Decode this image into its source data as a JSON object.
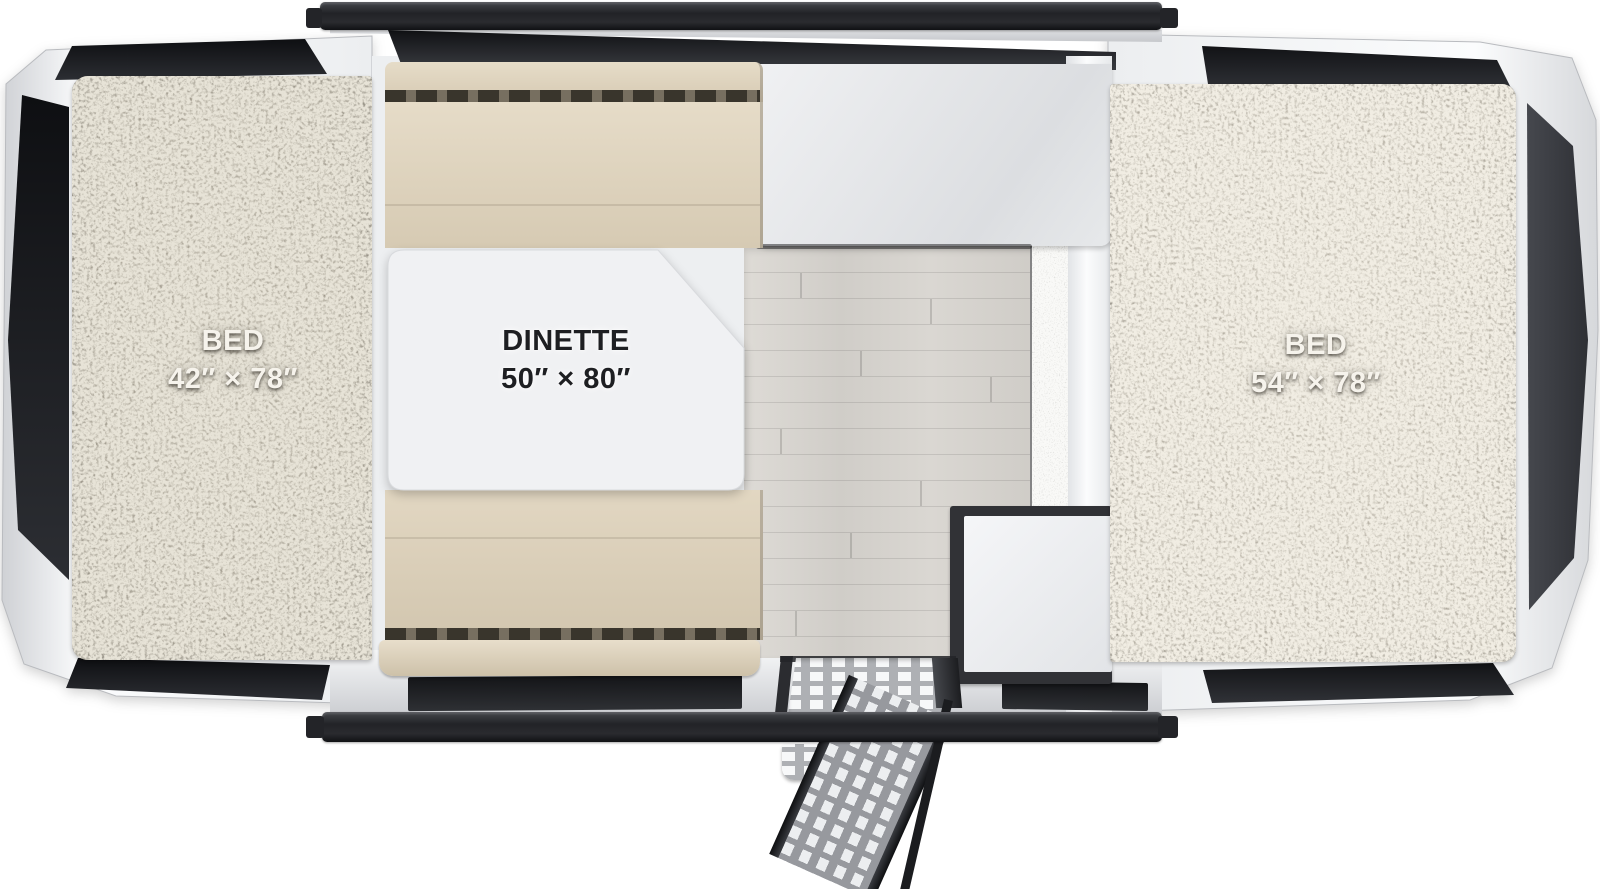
{
  "diagram": {
    "type": "rv_popup_camper_floorplan",
    "areas": {
      "bed_left": {
        "label": "BED",
        "size": "42″ × 78″"
      },
      "dinette": {
        "label": "DINETTE",
        "size": "50″ × 80″"
      },
      "bed_right": {
        "label": "BED",
        "size": "54″ × 78″"
      }
    },
    "features": [
      "fold-out tent bed (left)",
      "dinette with table",
      "kitchen counter",
      "storage cabinet",
      "entry step with fold-down ladder",
      "fold-out tent bed (right)",
      "wood-plank floor",
      "carpeted bunk ends"
    ],
    "colors": {
      "frame_rail": "#26272b",
      "body_white": "#f4f5f7",
      "window_dark": "#17181b",
      "tent_window_grey": "#3a3d42",
      "carpet_left": "#837c6f",
      "carpet_right": "#9b9488",
      "cushion_beige": "#ddd2bc",
      "cushion_tuft_band": "#776e5f",
      "table_white": "#f0f1f3",
      "wood_floor": "#d5d2cd",
      "counter": "#e6e8ea",
      "step_metal": "#b3b5b9"
    }
  }
}
